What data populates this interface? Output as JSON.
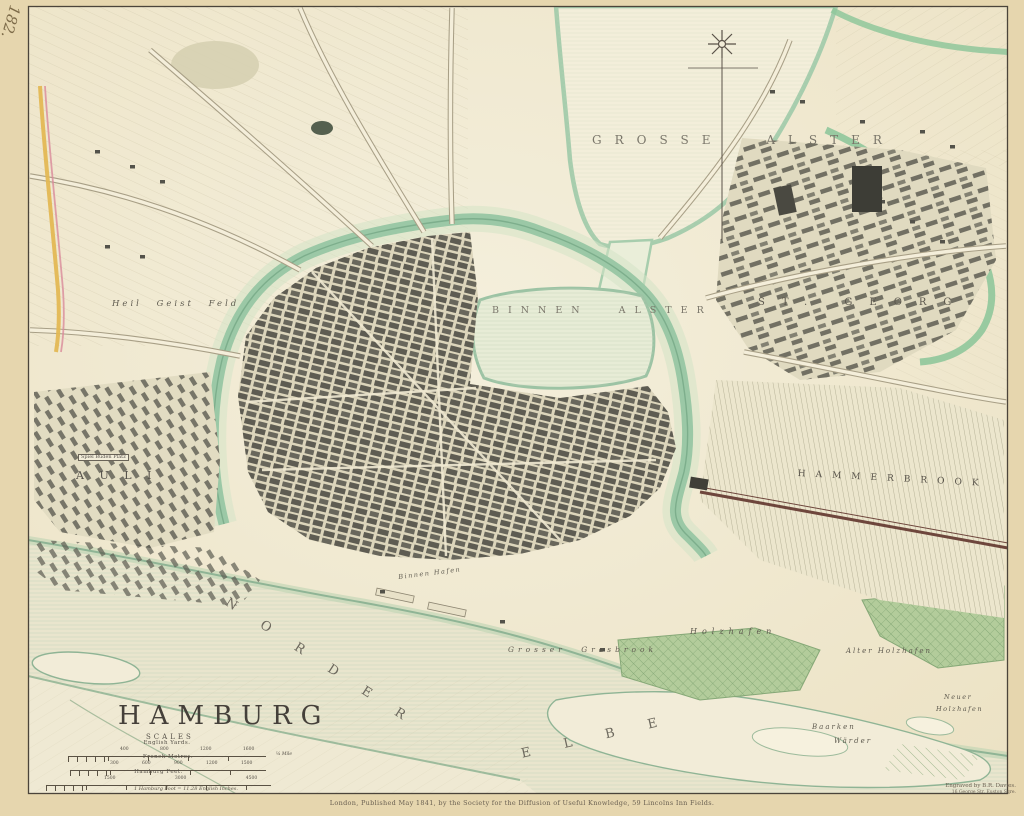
{
  "sheet": {
    "number": "182."
  },
  "title_block": {
    "title": "HAMBURG",
    "scales_heading": "SCALES",
    "scale_bars": [
      {
        "label": "English Yards.",
        "ticks": "400 800 1200 1600",
        "end": "¼ Mile"
      },
      {
        "label": "French Metres.",
        "ticks": "300 600 900 1200 1500",
        "end": ""
      },
      {
        "label": "Hamburg Feet.",
        "ticks": "1500 3000 4500",
        "end": ""
      }
    ],
    "footnote": "1 Hamburg Foot = 11.28 English Inches."
  },
  "imprint": {
    "publication": "London, Published May 1841, by the Society for the Diffusion of Useful Knowledge, 59 Lincolns Inn Fields.",
    "engraver_line1": "Engraved by B.R. Davies.",
    "engraver_line2": "16 George Str. Euston Sqre."
  },
  "labels": {
    "grosse_alster": "GROSSE ALSTER",
    "binnen_alster": "BINNEN ALSTER",
    "norder": "NORDER",
    "elbe": "ELBE",
    "heil_geist_feld": "Heil Geist Feld",
    "st_georg": "ST. GEORG",
    "hammerbrook": "HAMMERBROOK",
    "grosser_grasbrook": "Grosser Grasbrook",
    "holzhafen": "Holzhafen",
    "alter_holzhafen": "Alter Holzhafen",
    "neuer_holzhafen_line1": "Neuer",
    "neuer_holzhafen_line2": "Holzhafen",
    "baarken": "Baarken",
    "warder": "Wärder",
    "pauli": "A U L I",
    "spiel_buden_platz": "Spiel Buden Platz",
    "binnen_hafen": "Binnen Hafen"
  }
}
